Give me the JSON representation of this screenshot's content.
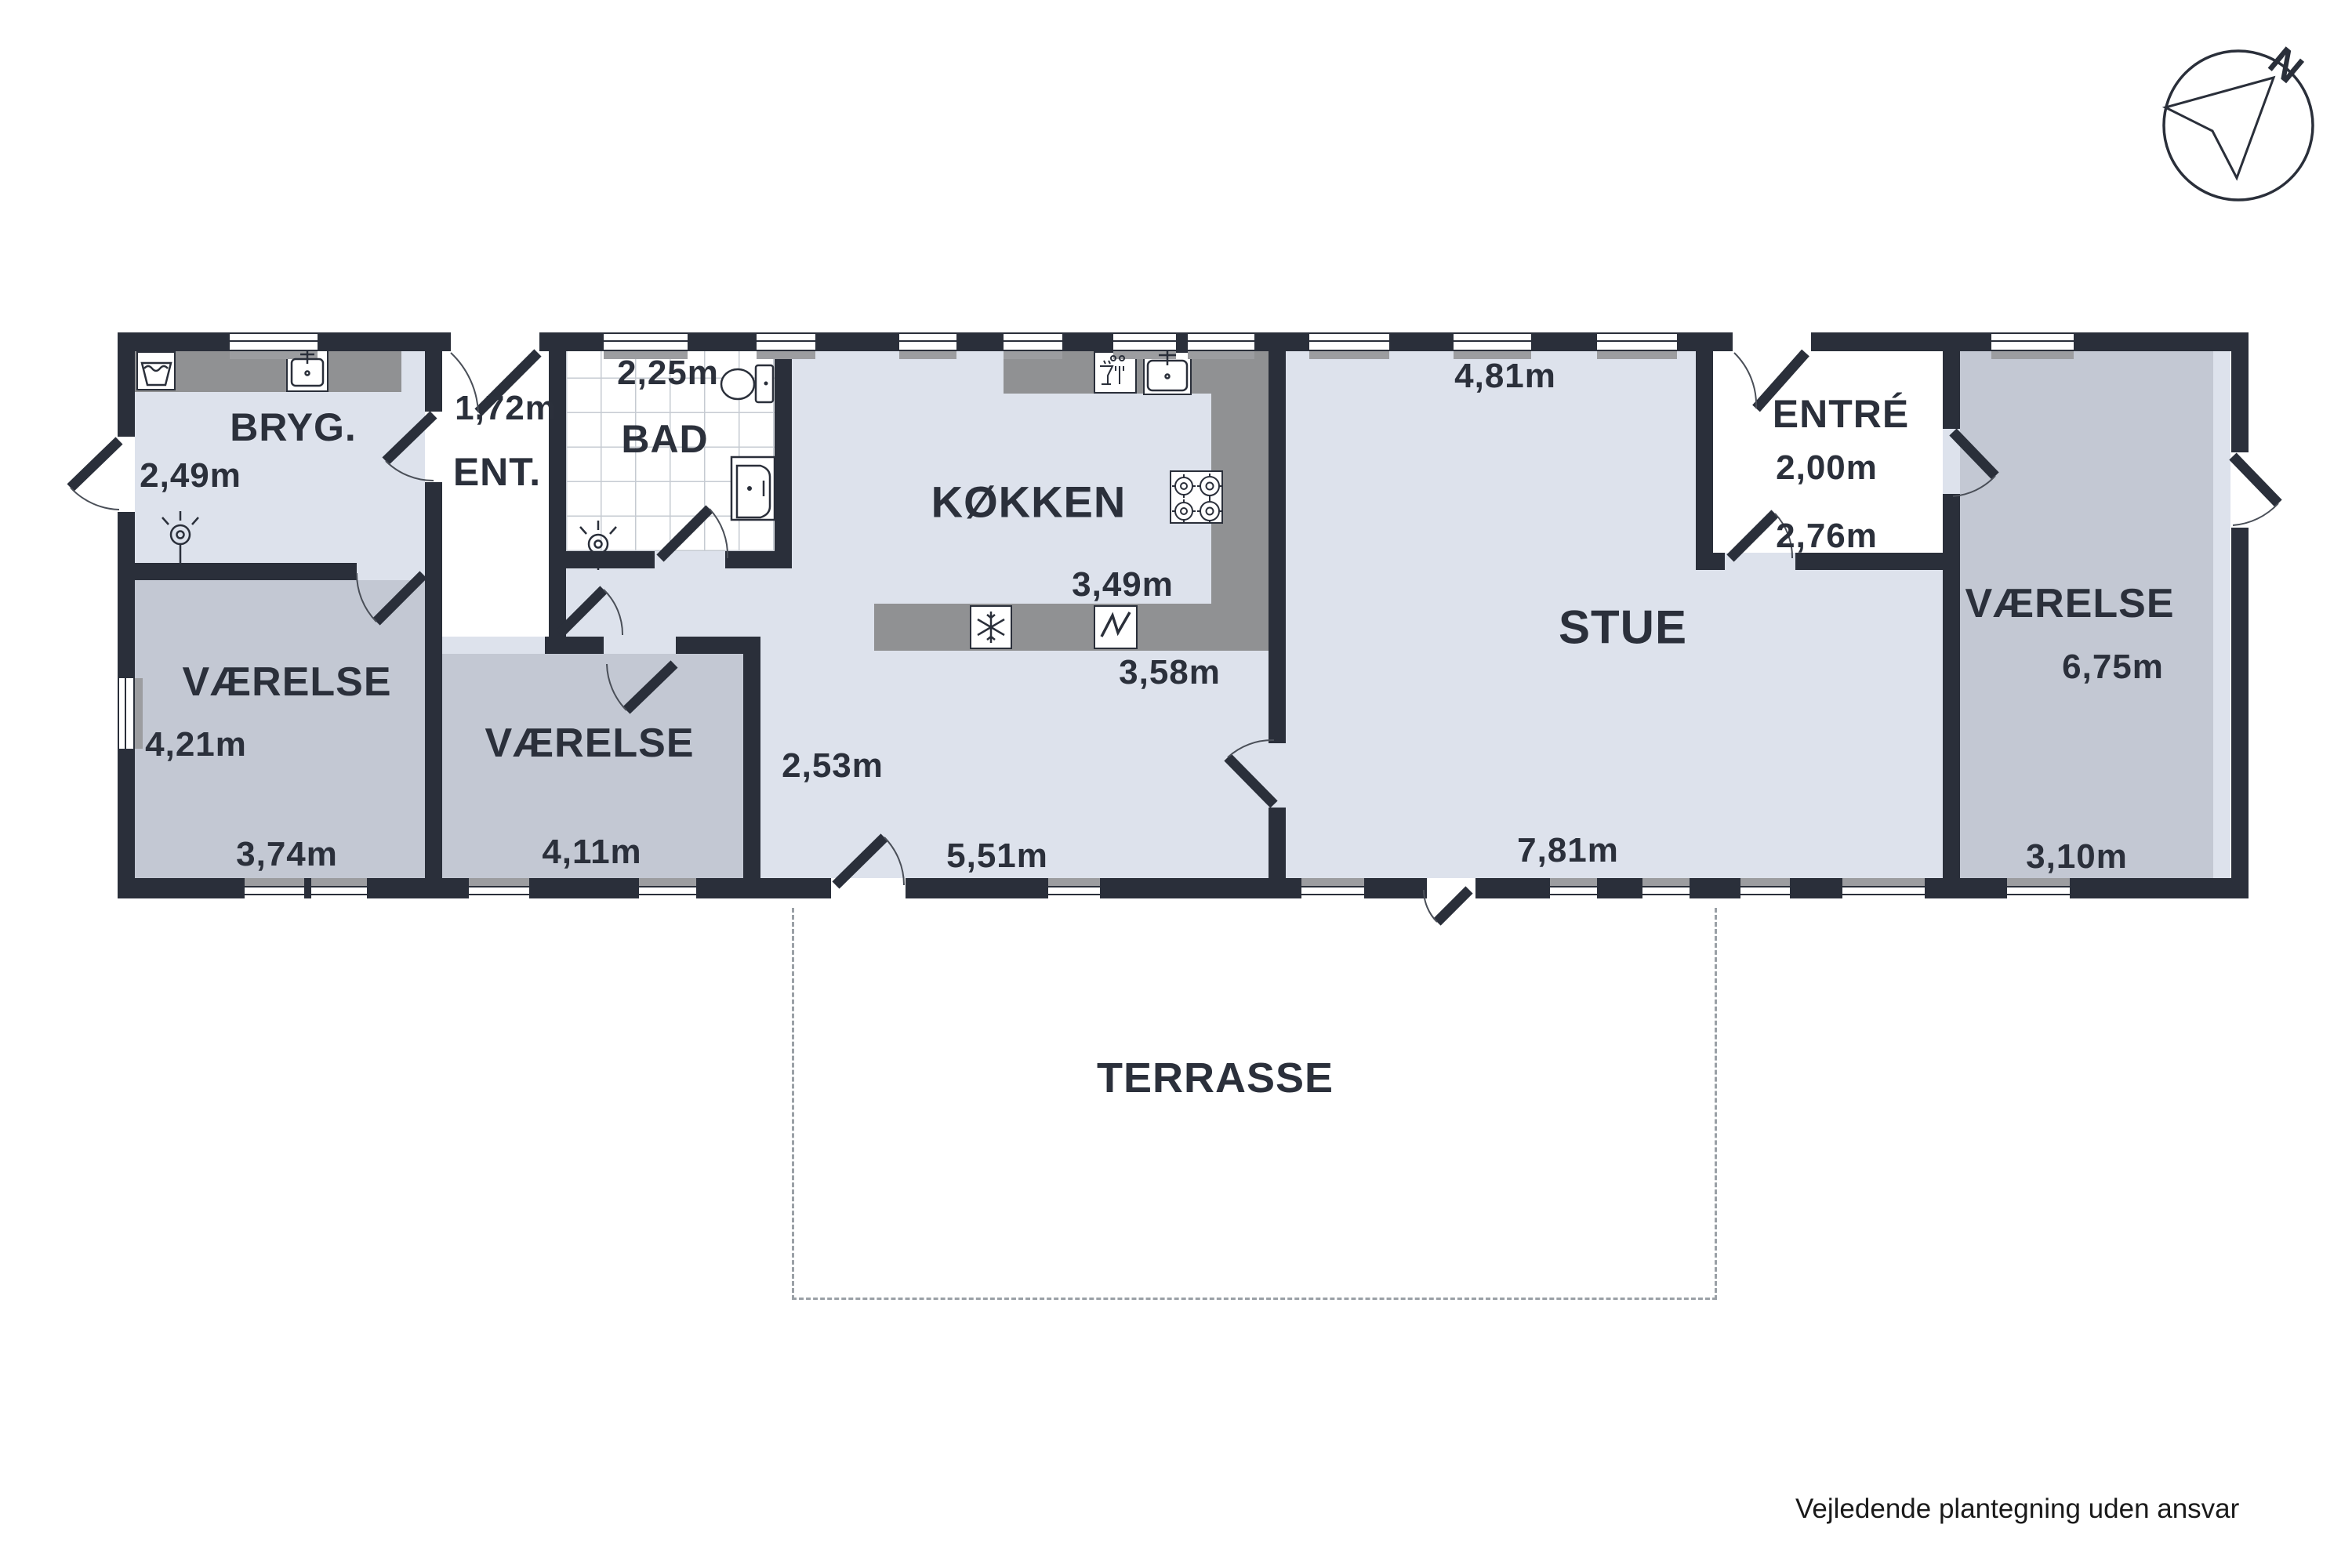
{
  "title": "Floor plan (plantegning)",
  "compass": {
    "label": "N"
  },
  "footer": {
    "disclaimer": "Vejledende plantegning uden ansvar"
  },
  "colors": {
    "wall": "#2a2f3a",
    "floor_light": "#dde2ec",
    "floor_gray": "#c3c8d3",
    "counter_gray": "#909193",
    "room_white": "#ffffff",
    "terrace_dash": "#9aa0a6"
  },
  "rooms": {
    "bryg": {
      "label": "BRYG.",
      "dim_w": "2,49m"
    },
    "ent": {
      "label": "ENT.",
      "dim_w": "1,72m"
    },
    "bad": {
      "label": "BAD",
      "dim_w": "2,25m"
    },
    "kokken": {
      "label": "KØKKEN",
      "dim_w": "3,49m",
      "dim_w2": "3,58m"
    },
    "hall": {
      "dim_w": "2,53m",
      "dim_l": "5,51m"
    },
    "stue": {
      "label": "STUE",
      "dim_top": "4,81m",
      "dim_bottom": "7,81m"
    },
    "entre": {
      "label": "ENTRÉ",
      "dim_w": "2,00m",
      "dim_l": "2,76m"
    },
    "vaerelse_left": {
      "label": "VÆRELSE",
      "dim_h": "4,21m",
      "dim_w": "3,74m"
    },
    "vaerelse_mid": {
      "label": "VÆRELSE",
      "dim_w": "4,11m"
    },
    "vaerelse_right": {
      "label": "VÆRELSE",
      "dim_h": "6,75m",
      "dim_w": "3,10m"
    },
    "terrasse": {
      "label": "TERRASSE"
    }
  },
  "icons": [
    "north-arrow-icon",
    "washing-machine-icon",
    "utility-sink-icon",
    "ceiling-lamp-icon",
    "toilet-icon",
    "bathroom-sink-icon",
    "dishwasher-icon",
    "kitchen-sink-icon",
    "stove-icon",
    "freezer-icon",
    "oven-icon"
  ]
}
